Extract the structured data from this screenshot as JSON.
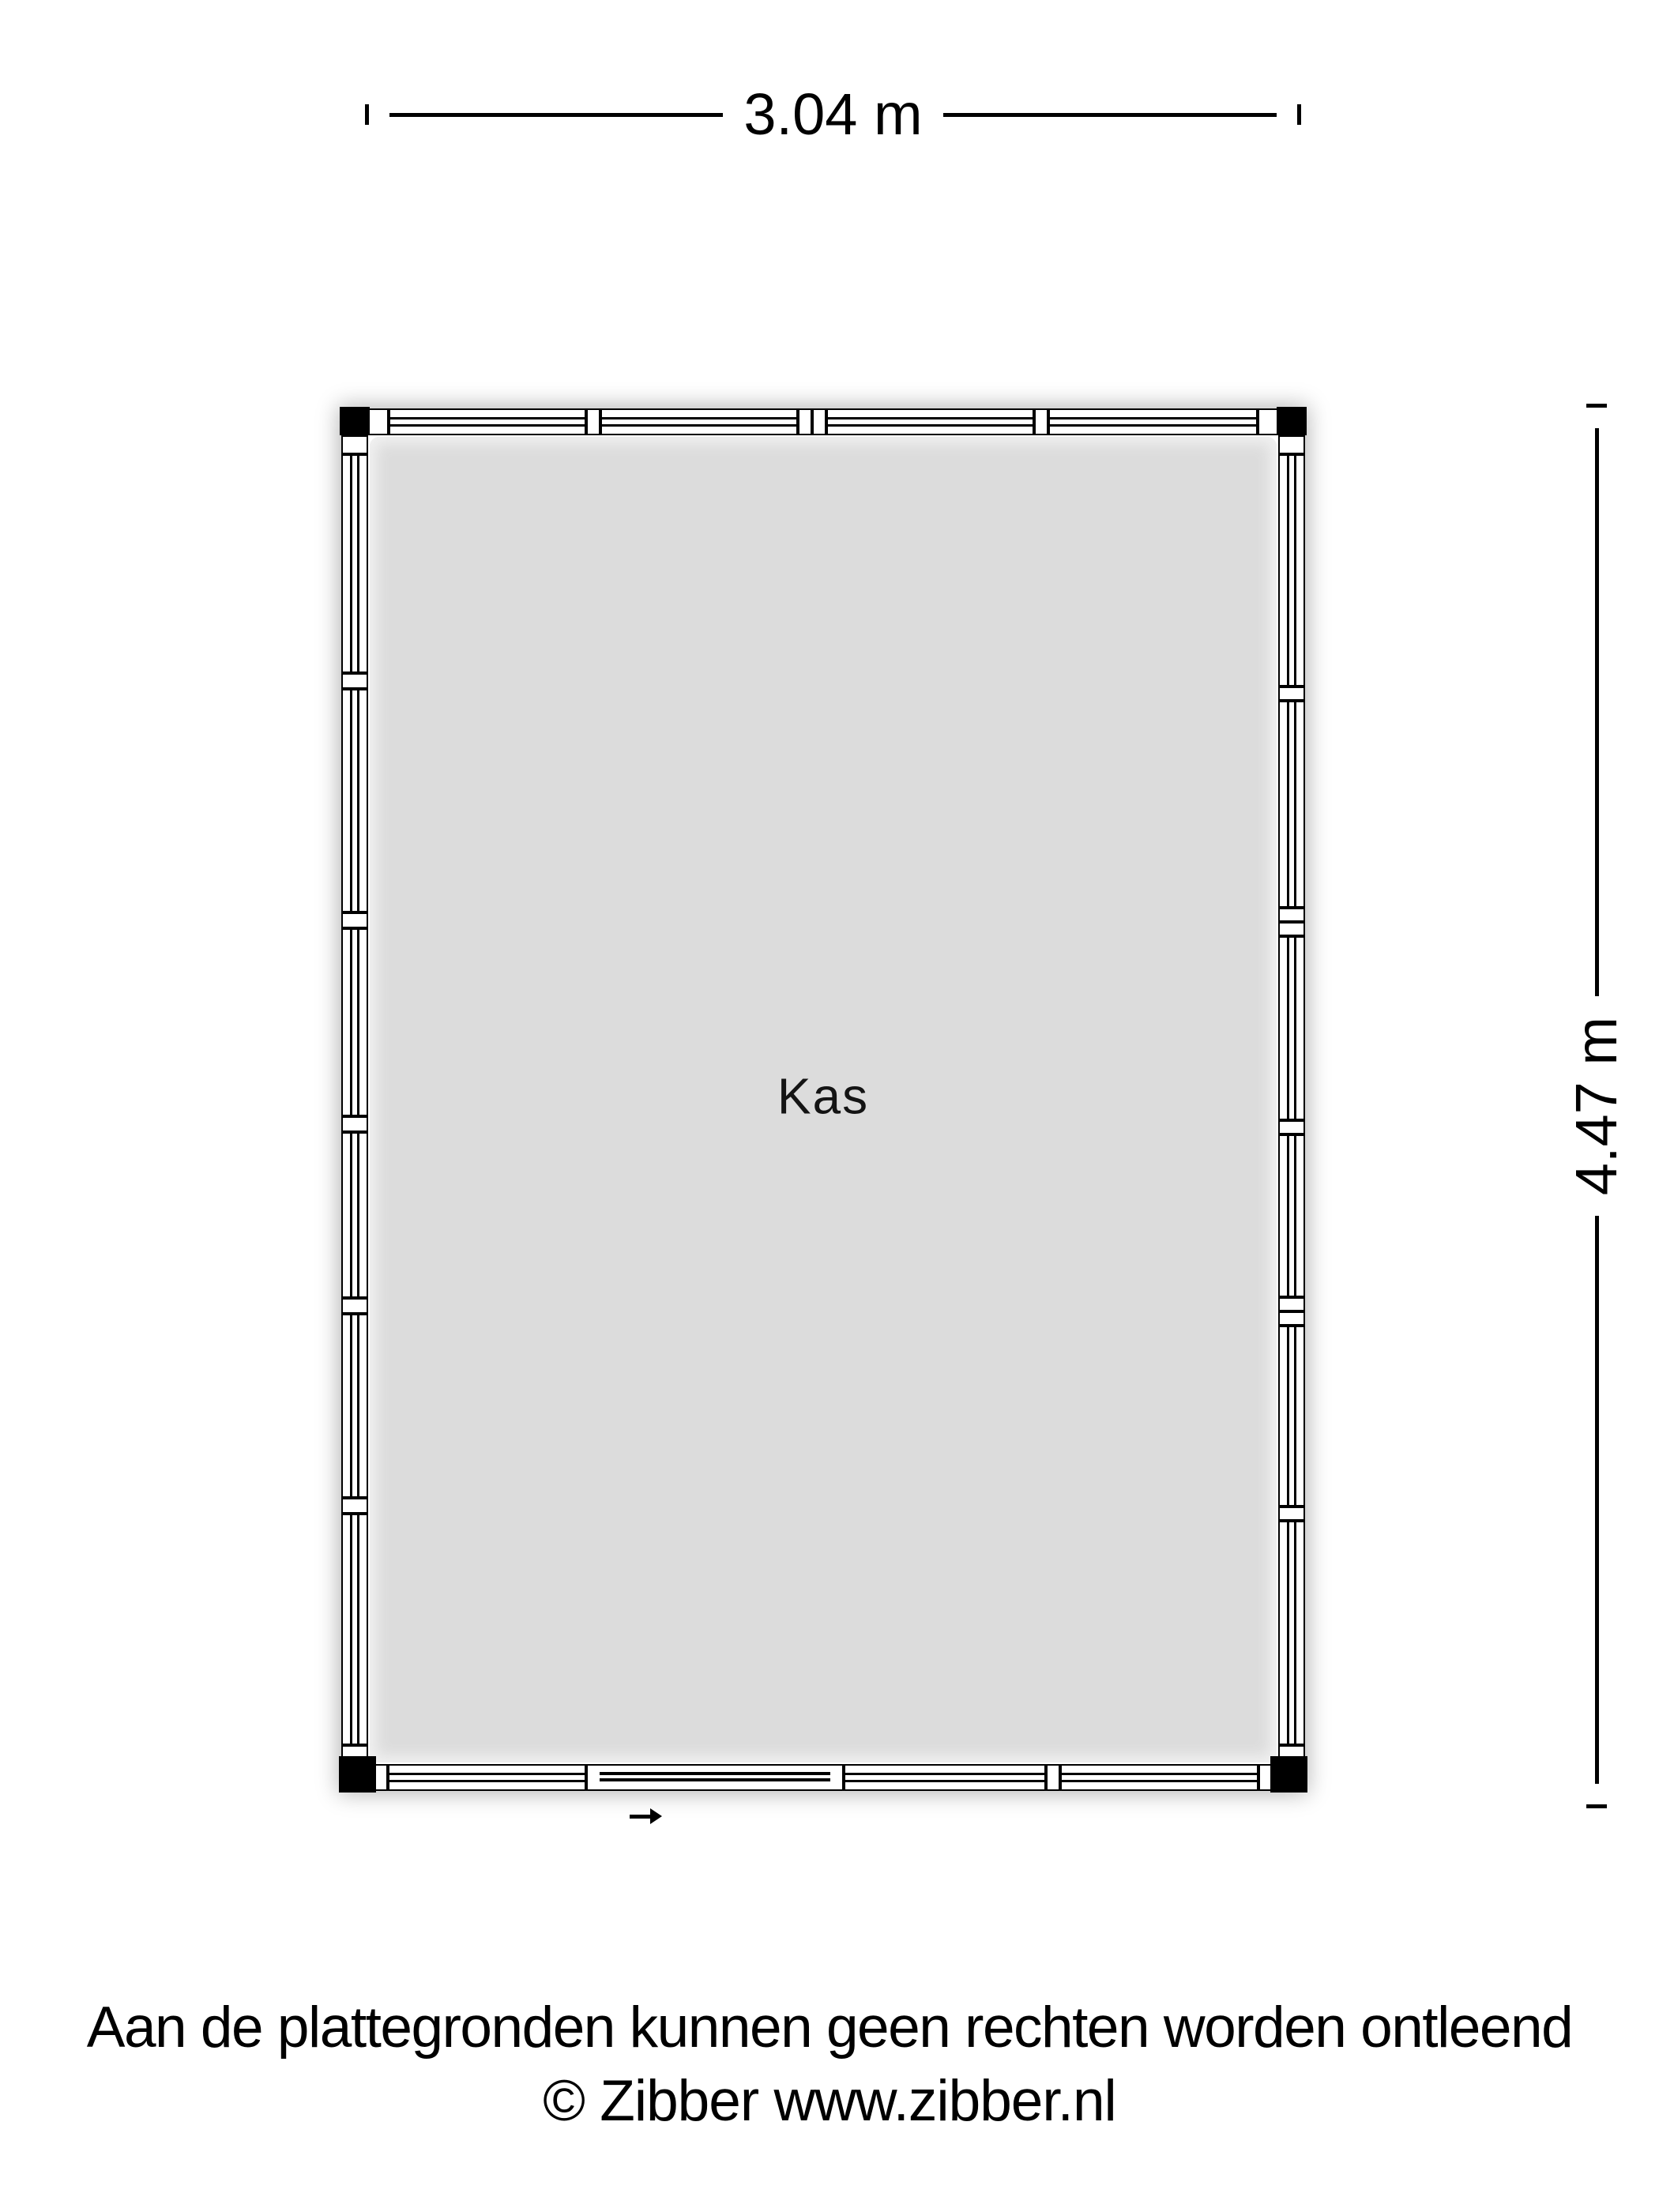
{
  "page": {
    "type": "floorplan",
    "room": {
      "label": "Kas"
    },
    "dimensions": {
      "width_label": "3.04 m",
      "height_label": "4.47 m"
    },
    "footer": {
      "line1": "Aan de plattegronden kunnen geen rechten worden ontleend",
      "line2": "© Zibber www.zibber.nl"
    }
  },
  "colors": {
    "line": "#000000",
    "wall": "#ffffff",
    "floor": "#dcdcdc",
    "page_background": "#ffffff"
  },
  "plan": {
    "entrance": {
      "icon": "right-arrow",
      "direction": "right"
    },
    "walls": {
      "top": {
        "orientation": "h",
        "segments": [
          {
            "kind": "mullion",
            "px": 26
          },
          {
            "kind": "glass",
            "flex": 1.0
          },
          {
            "kind": "mullion",
            "px": 18
          },
          {
            "kind": "glass",
            "flex": 1.0
          },
          {
            "kind": "mullion",
            "px": 18
          },
          {
            "kind": "mullion",
            "px": 18
          },
          {
            "kind": "glass",
            "flex": 1.05
          },
          {
            "kind": "mullion",
            "px": 18
          },
          {
            "kind": "glass",
            "flex": 1.06
          },
          {
            "kind": "mullion",
            "px": 26
          }
        ]
      },
      "bottom": {
        "orientation": "h",
        "segments": [
          {
            "kind": "mullion",
            "px": 25
          },
          {
            "kind": "glass",
            "flex": 1.0
          },
          {
            "kind": "door",
            "flex": 1.3
          },
          {
            "kind": "glass",
            "flex": 1.02
          },
          {
            "kind": "mullion",
            "px": 18
          },
          {
            "kind": "glass",
            "flex": 1.0
          },
          {
            "kind": "mullion",
            "px": 25
          }
        ]
      },
      "left": {
        "orientation": "v",
        "segments": [
          {
            "kind": "mullion",
            "px": 24
          },
          {
            "kind": "glass",
            "flex": 1.05
          },
          {
            "kind": "mullion",
            "px": 20
          },
          {
            "kind": "glass",
            "flex": 1.07
          },
          {
            "kind": "mullion",
            "px": 20
          },
          {
            "kind": "glass",
            "flex": 0.9
          },
          {
            "kind": "mullion",
            "px": 20
          },
          {
            "kind": "glass",
            "flex": 0.79
          },
          {
            "kind": "mullion",
            "px": 20
          },
          {
            "kind": "glass",
            "flex": 0.88
          },
          {
            "kind": "mullion",
            "px": 20
          },
          {
            "kind": "glass",
            "flex": 1.11
          },
          {
            "kind": "mullion",
            "px": 24
          }
        ]
      },
      "right": {
        "orientation": "v",
        "segments": [
          {
            "kind": "mullion",
            "px": 24
          },
          {
            "kind": "glass",
            "flex": 1.15
          },
          {
            "kind": "mullion",
            "px": 18
          },
          {
            "kind": "glass",
            "flex": 1.02
          },
          {
            "kind": "mullion",
            "px": 18
          },
          {
            "kind": "mullion",
            "px": 18
          },
          {
            "kind": "glass",
            "flex": 0.91
          },
          {
            "kind": "mullion",
            "px": 18
          },
          {
            "kind": "glass",
            "flex": 0.8
          },
          {
            "kind": "mullion",
            "px": 18
          },
          {
            "kind": "mullion",
            "px": 18
          },
          {
            "kind": "glass",
            "flex": 0.89
          },
          {
            "kind": "mullion",
            "px": 18
          },
          {
            "kind": "glass",
            "flex": 1.11
          },
          {
            "kind": "mullion",
            "px": 24
          }
        ]
      }
    }
  }
}
